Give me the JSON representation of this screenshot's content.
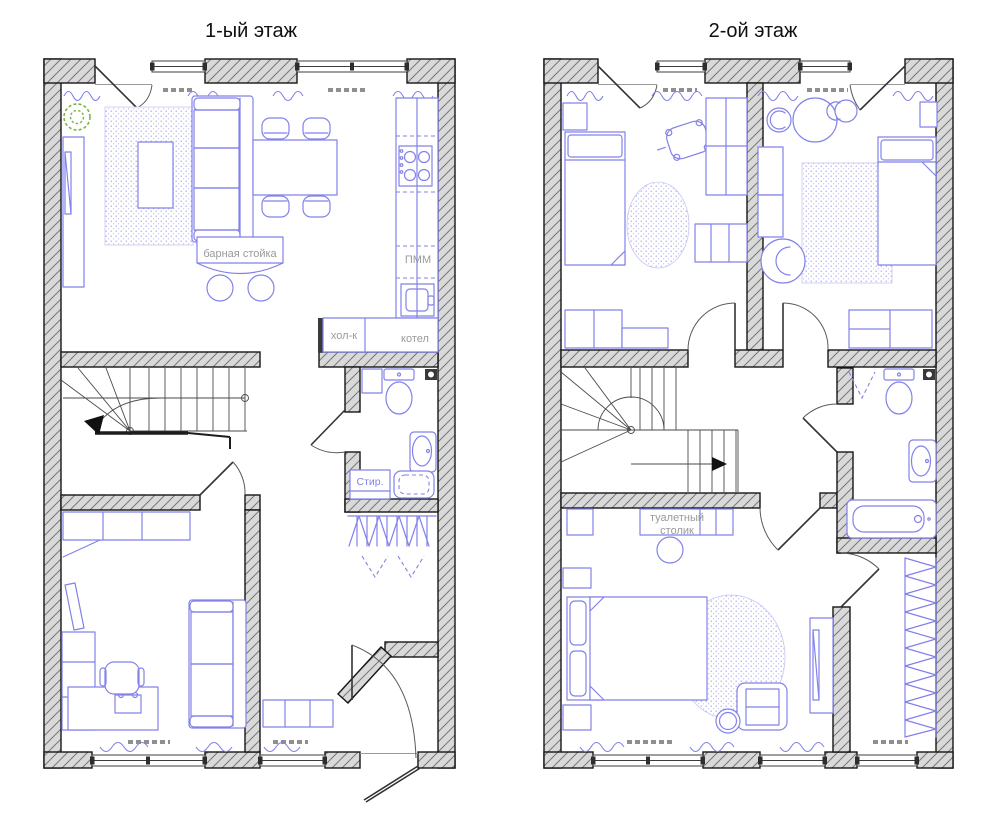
{
  "meta": {
    "width": 1000,
    "height": 827,
    "background": "#ffffff"
  },
  "floor1": {
    "title": "1-ый этаж",
    "labels": {
      "bar_counter": "барная стойка",
      "dishwasher": "ПММ",
      "fridge": "хол-к",
      "boiler": "котел",
      "washer": "Стир."
    }
  },
  "floor2": {
    "title": "2-ой этаж",
    "labels": {
      "dressing_table_line1": "туалетный",
      "dressing_table_line2": "столик"
    }
  },
  "colors": {
    "wall_fill": "#d9d9d9",
    "wall_hatch": "#787878",
    "outline": "#161616",
    "furniture_blue": "#8282ea",
    "rug_dots": "#a0a0e6",
    "label_gray": "#9a9a9a",
    "plant_green": "#79b342",
    "title_text": "#101010"
  }
}
